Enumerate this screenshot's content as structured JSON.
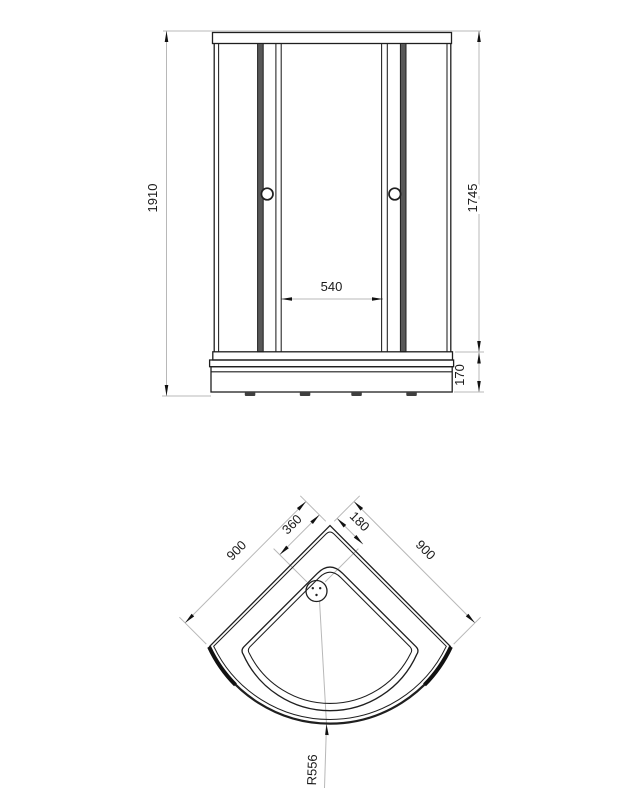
{
  "drawing": {
    "type": "technical-drawing",
    "subject": "corner shower cabin with quadrant tray",
    "colors": {
      "background": "#ffffff",
      "object_line": "#1f1f1f",
      "dimension_line": "#b8b8b8",
      "text": "#1a1a1a",
      "door_stile_fill": "#585858",
      "foot_fill": "#3f3f3f"
    },
    "front_view": {
      "name": "front-elevation",
      "dims": {
        "overall_height": "1910",
        "frame_height": "1745",
        "opening_width": "540",
        "tray_height": "170"
      }
    },
    "plan_view": {
      "name": "tray-plan",
      "dims": {
        "side_left": "900",
        "side_right": "900",
        "drain_offset_left": "360",
        "drain_offset_right": "180",
        "front_radius": "R556"
      }
    }
  }
}
